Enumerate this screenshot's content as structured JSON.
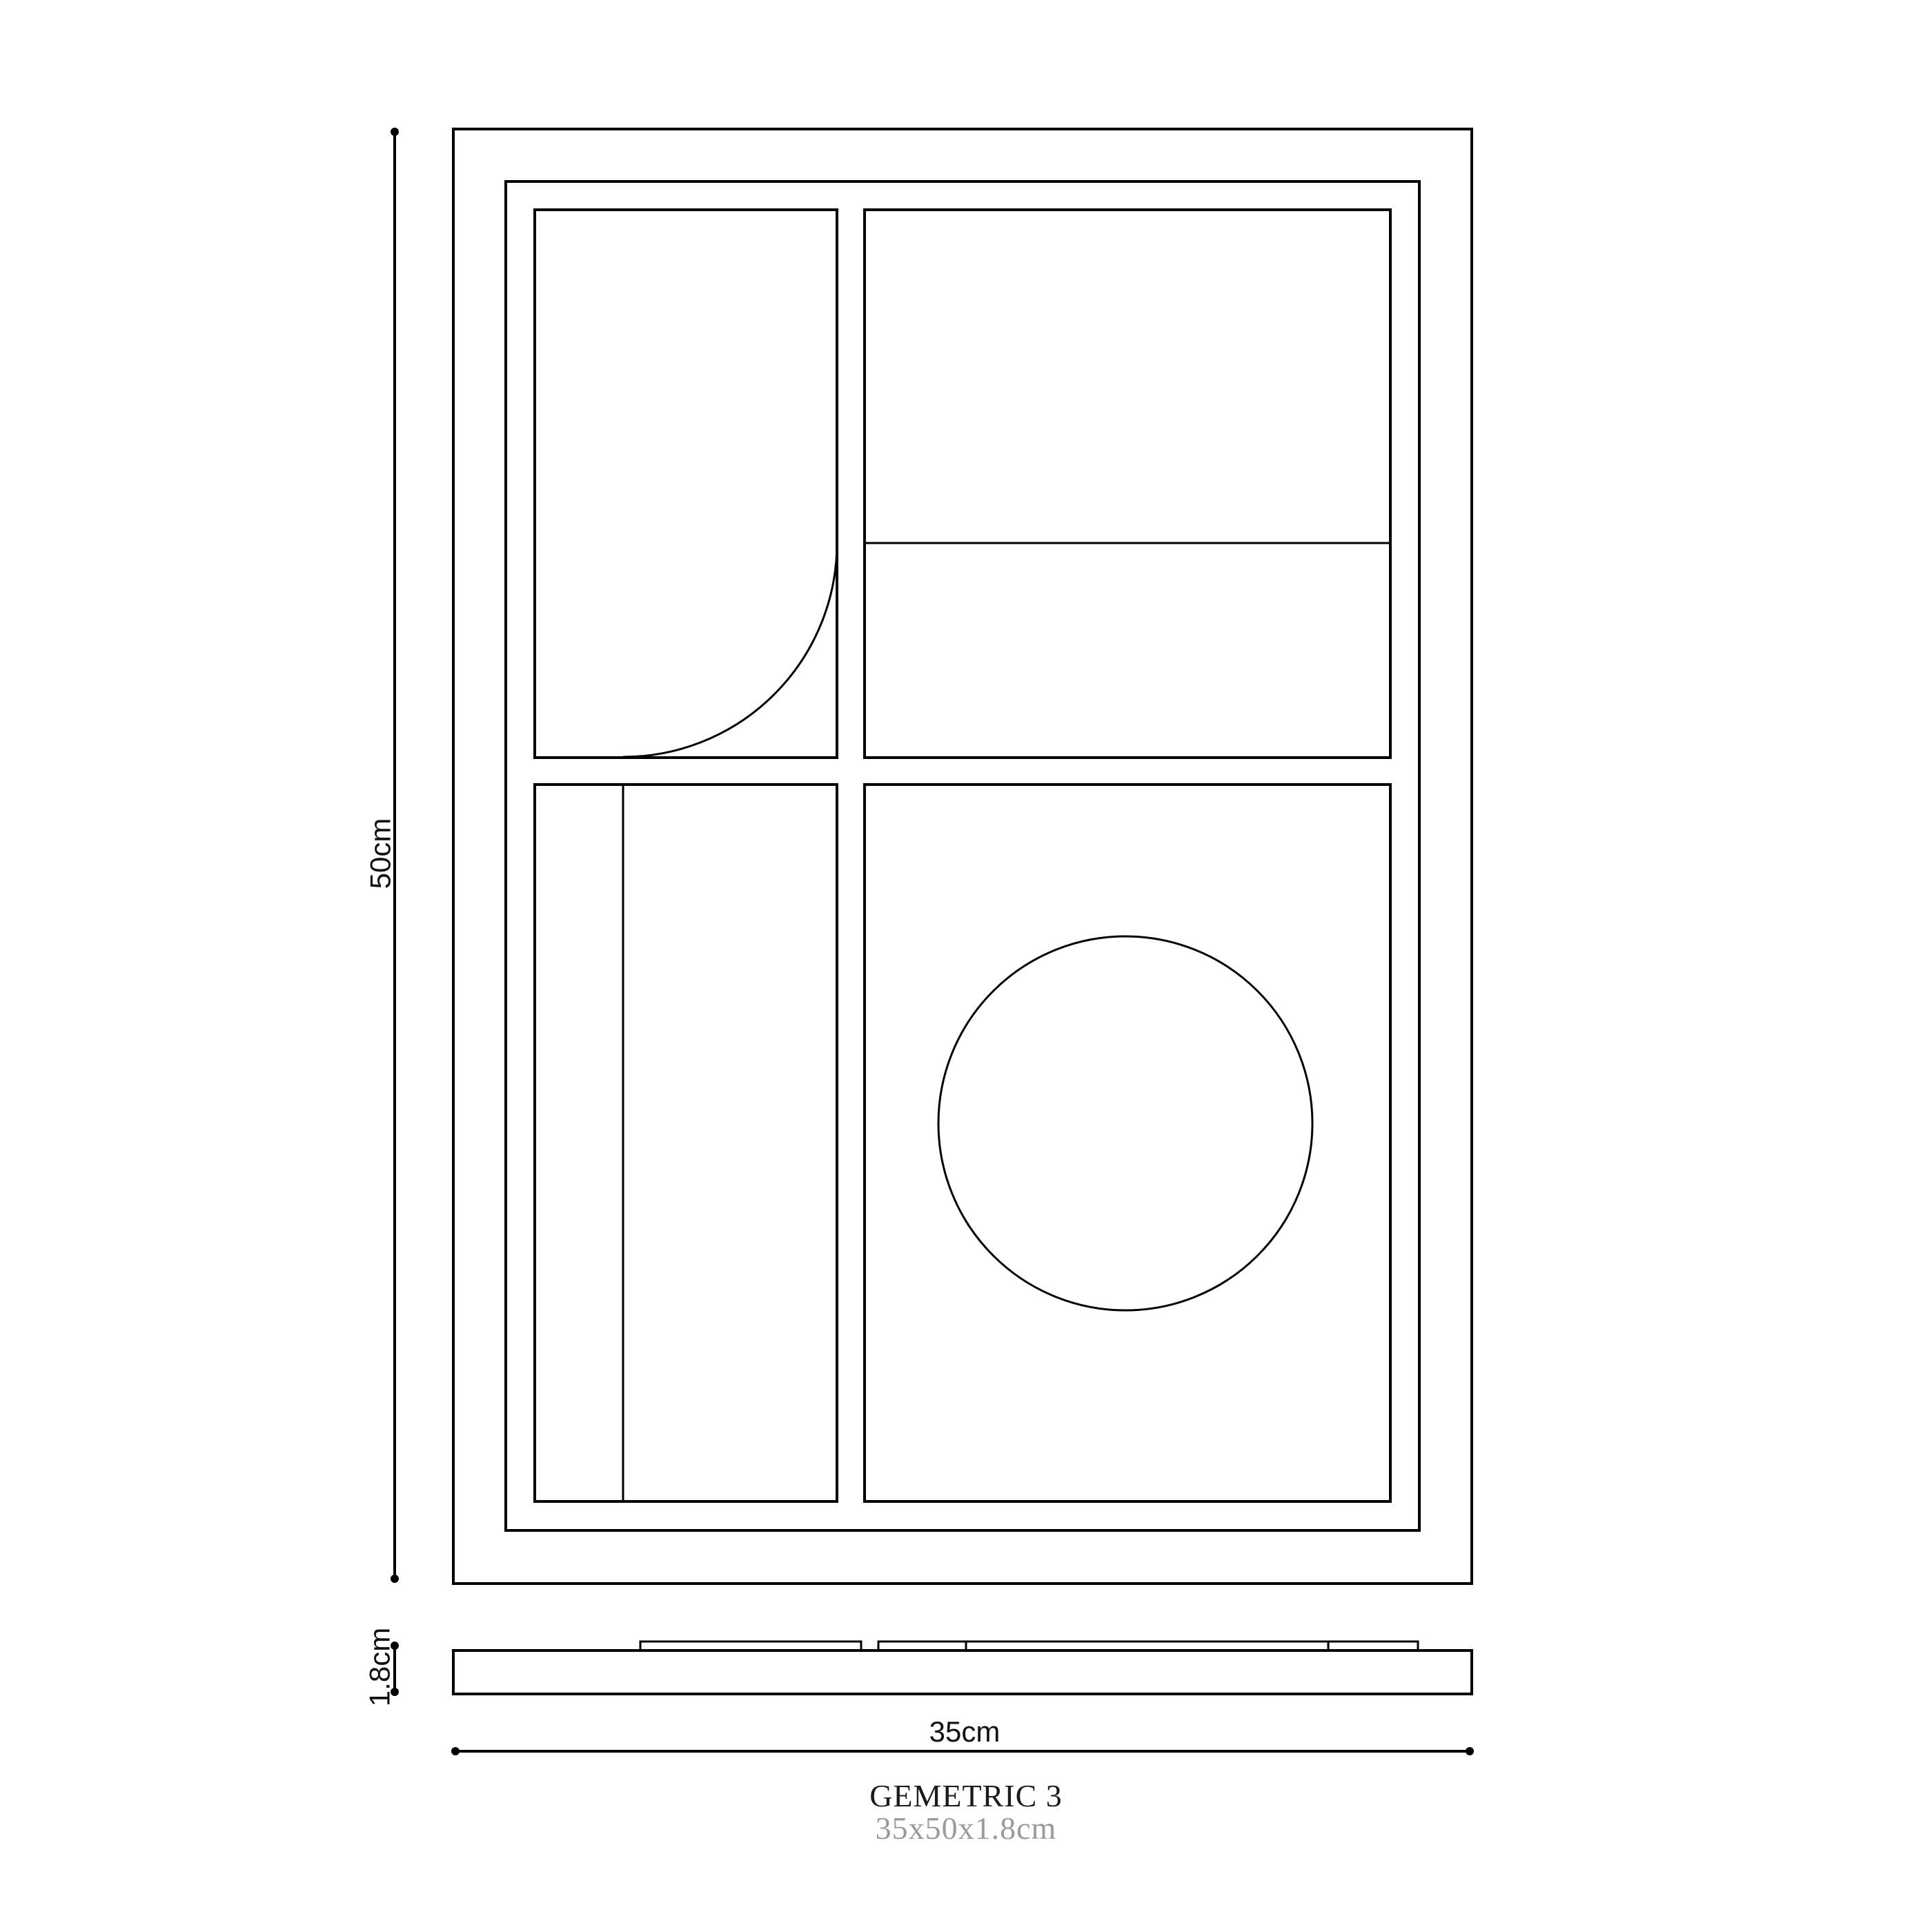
{
  "product": {
    "title": "GEMETRIC 3",
    "dimensions_summary": "35x50x1.8cm"
  },
  "dimension_labels": {
    "height": "50cm",
    "width": "35cm",
    "thickness": "1.8cm"
  },
  "colors": {
    "line": "#000000",
    "dim_label": "#111111",
    "title": "#1b1b1b",
    "subtitle": "#9a9a9a",
    "background": "#ffffff"
  }
}
